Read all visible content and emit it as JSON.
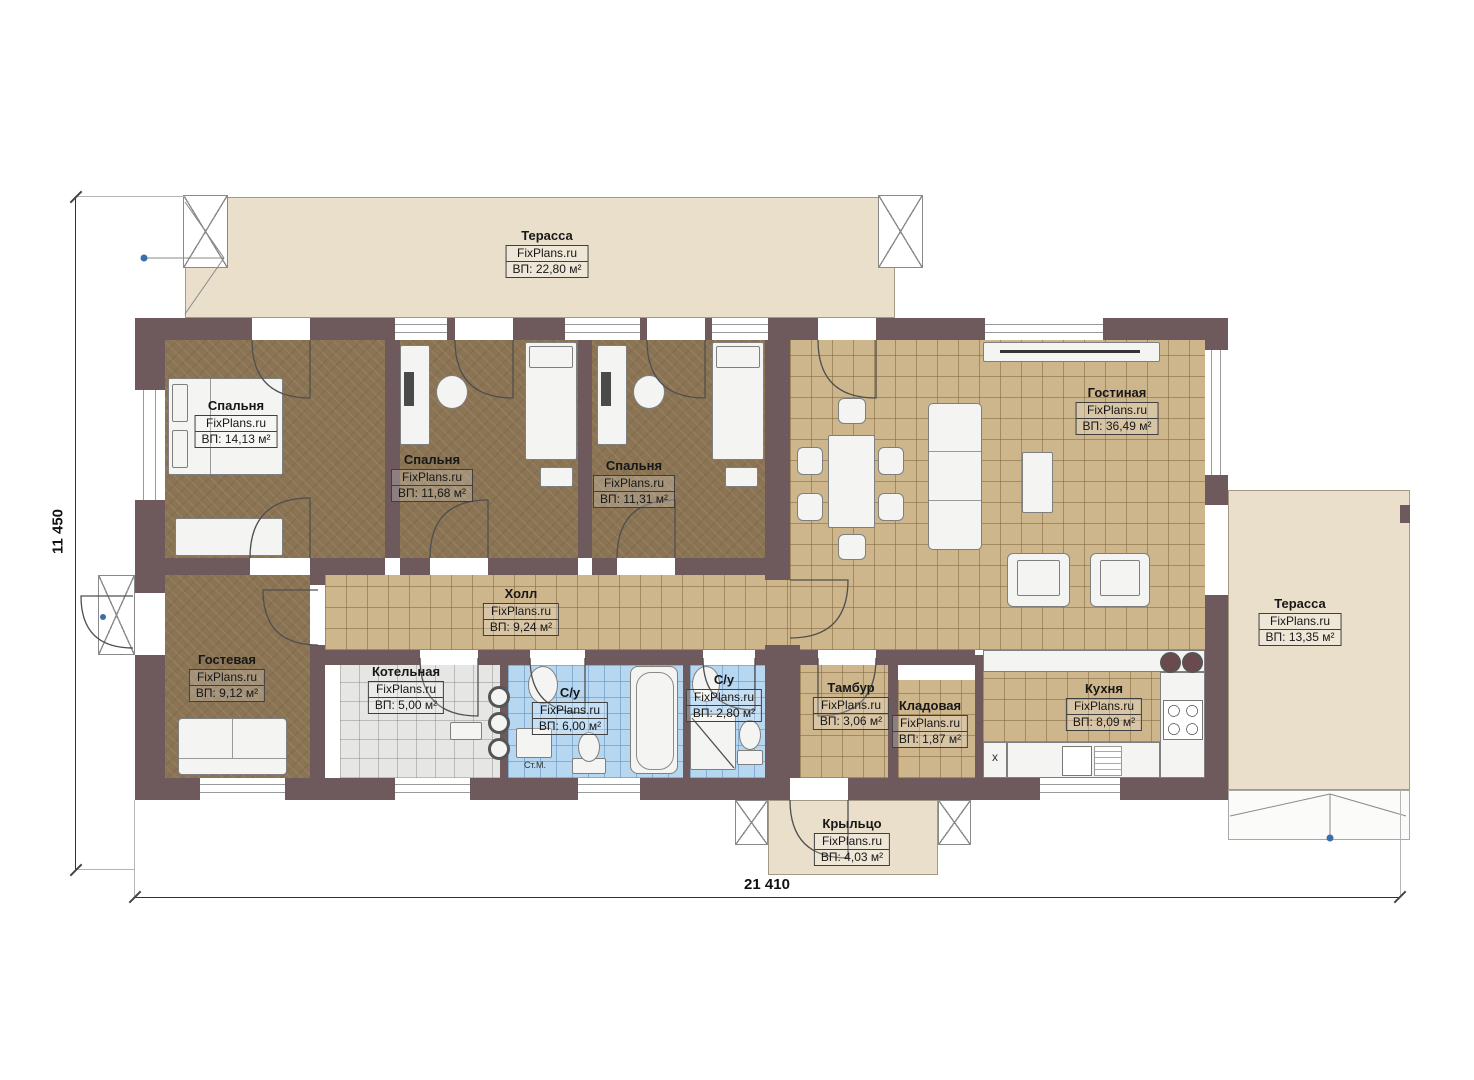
{
  "brand": "FixPlans.ru",
  "dimensions": {
    "horizontal": "21 410",
    "vertical": "11 450"
  },
  "rooms": [
    {
      "id": "terrace-top",
      "name": "Терасса",
      "area": "ВП: 22,80 м²"
    },
    {
      "id": "bedroom-1",
      "name": "Спальня",
      "area": "ВП: 14,13 м²"
    },
    {
      "id": "bedroom-2",
      "name": "Спальня",
      "area": "ВП: 11,68 м²"
    },
    {
      "id": "bedroom-3",
      "name": "Спальня",
      "area": "ВП: 11,31 м²"
    },
    {
      "id": "living-room",
      "name": "Гостиная",
      "area": "ВП: 36,49 м²"
    },
    {
      "id": "terrace-right",
      "name": "Терасса",
      "area": "ВП: 13,35 м²"
    },
    {
      "id": "hall",
      "name": "Холл",
      "area": "ВП: 9,24 м²"
    },
    {
      "id": "guest-room",
      "name": "Гостевая",
      "area": "ВП: 9,12 м²"
    },
    {
      "id": "boiler-room",
      "name": "Котельная",
      "area": "ВП: 5,00 м²"
    },
    {
      "id": "bathroom-1",
      "name": "С/у",
      "area": "ВП: 6,00 м²"
    },
    {
      "id": "bathroom-2",
      "name": "С/у",
      "area": "ВП: 2,80 м²"
    },
    {
      "id": "vestibule",
      "name": "Тамбур",
      "area": "ВП: 3,06 м²"
    },
    {
      "id": "storage",
      "name": "Кладовая",
      "area": "ВП: 1,87 м²"
    },
    {
      "id": "kitchen",
      "name": "Кухня",
      "area": "ВП: 8,09 м²"
    },
    {
      "id": "porch",
      "name": "Крыльцо",
      "area": "ВП: 4,03 м²"
    }
  ],
  "annotations": {
    "washing_machine": "Ст.М.",
    "fridge_mark": "x"
  },
  "colors": {
    "wall": "#6e5a5c",
    "floor_wood": "#8b7453",
    "floor_tile": "#cdb58c",
    "floor_bath": "#b7d7f0",
    "floor_boiler": "#e6e6e4",
    "terrace": "#e9dfcb",
    "marker_dot": "#3a6ea8"
  }
}
